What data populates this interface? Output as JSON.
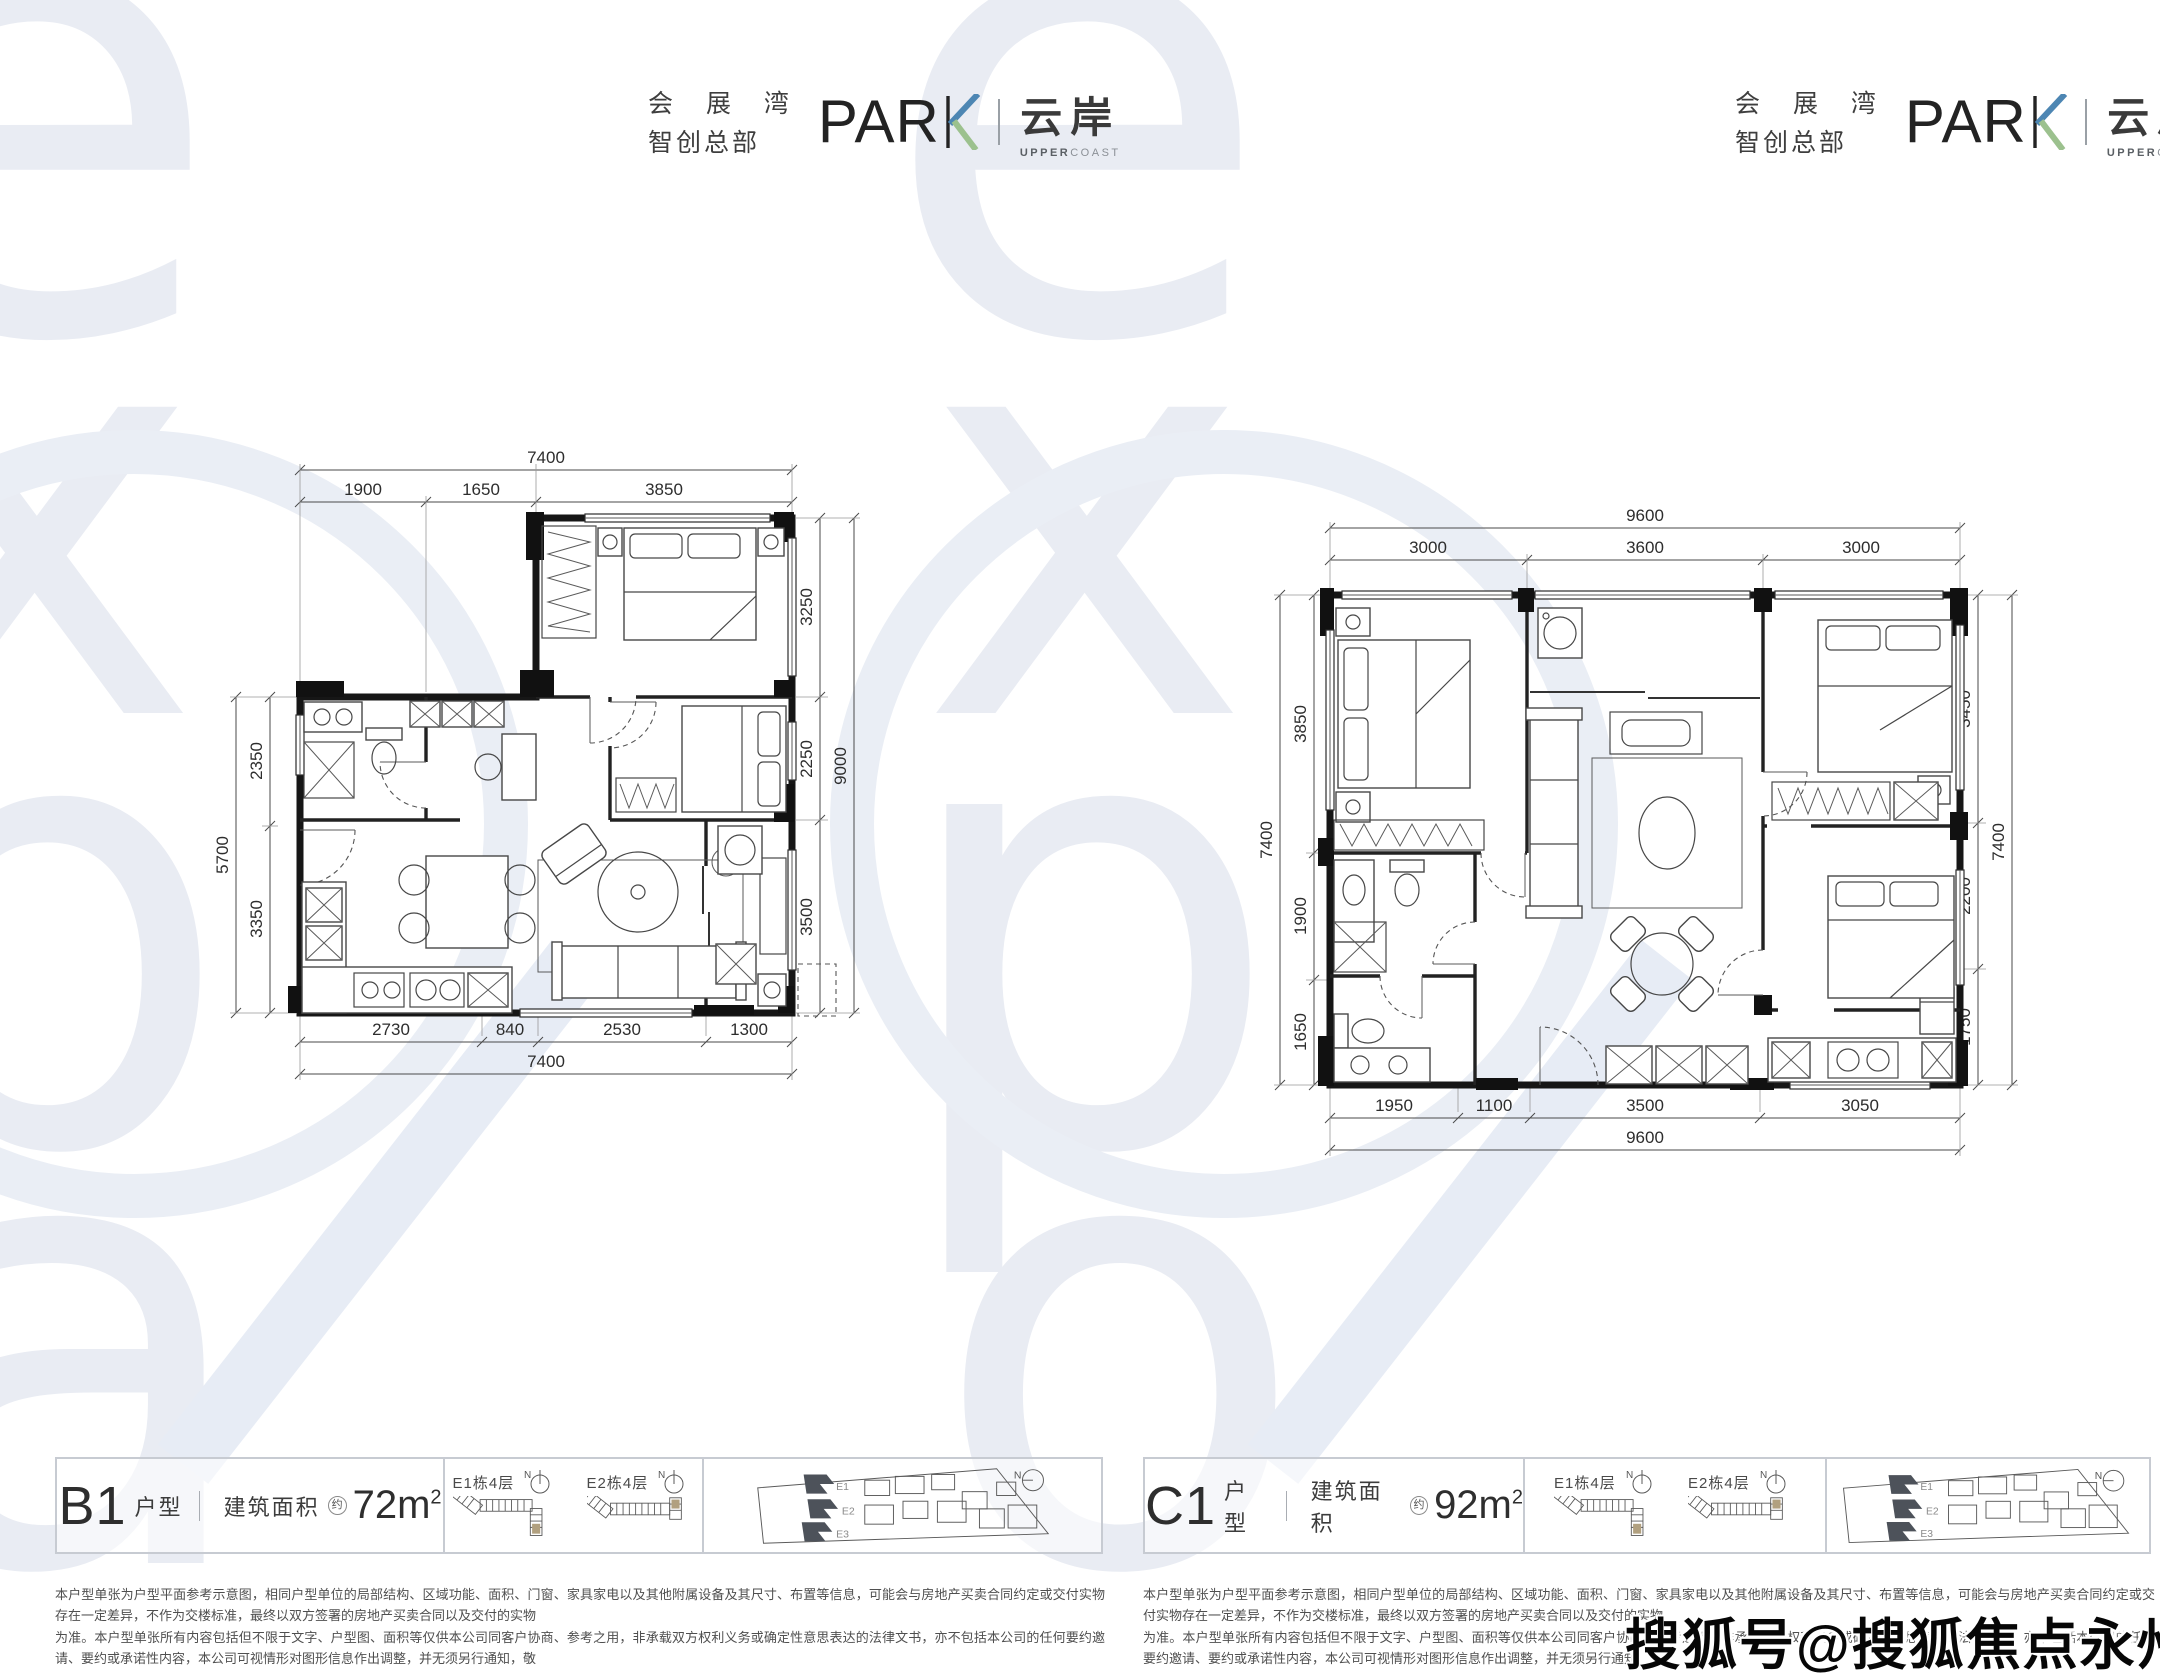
{
  "logo": {
    "cn_line1": "会 展 湾",
    "cn_line2": "智创总部",
    "park": "PAR",
    "brand": "云岸",
    "brand_sub_strong": "UPPER",
    "brand_sub_light": "COAST"
  },
  "plans": {
    "b1": {
      "code": "B1",
      "type_label": "户型",
      "area_label": "建筑面积",
      "approx": "约",
      "area": "72m",
      "area_exp": "2",
      "dims": {
        "top_total": "7400",
        "top": [
          "1900",
          "1650",
          "3850"
        ],
        "left_total": "5700",
        "left": [
          "2350",
          "3350"
        ],
        "right_total": "9000",
        "right": [
          "3250",
          "2250",
          "3500"
        ],
        "bottom_total": "7400",
        "bottom": [
          "2730",
          "840",
          "2530",
          "1300"
        ]
      }
    },
    "c1": {
      "code": "C1",
      "type_label": "户型",
      "area_label": "建筑面积",
      "approx": "约",
      "area": "92m",
      "area_exp": "2",
      "dims": {
        "top_total": "9600",
        "top": [
          "3000",
          "3600",
          "3000"
        ],
        "left_total": "7400",
        "left": [
          "3850",
          "1900",
          "1650"
        ],
        "right_total": "7400",
        "right": [
          "3450",
          "2200",
          "1750"
        ],
        "bottom_total": "9600",
        "bottom": [
          "1950",
          "1100",
          "3500",
          "3050"
        ]
      }
    }
  },
  "legend": {
    "e1": "E1栋4层",
    "e2": "E2栋4层",
    "north": "N",
    "site_e1": "E1",
    "site_e2": "E2",
    "site_e3": "E3"
  },
  "disclaimer": {
    "line1": "本户型单张为户型平面参考示意图，相同户型单位的局部结构、区域功能、面积、门窗、家具家电以及其他附属设备及其尺寸、布置等信息，可能会与房地产买卖合同约定或交付实物存在一定差异，不作为交楼标准，最终以双方签署的房地产买卖合同以及交付的实物",
    "line2": "为准。本户型单张所有内容包括但不限于文字、户型图、面积等仅供本公司同客户协商、参考之用，非承载双方权利义务或确定性意思表达的法律文书，亦不包括本公司的任何要约邀请、要约或承诺性内容，本公司可视情形对图形信息作出调整，并无须另行通知，敬",
    "line3": "请留意本公司最新宣传说明。该户型单张上的户型平面落位为标准层平面图，不同楼层的户型分布可能会存在差异；部分户型结构、户型落位为镜像关系，敬请留意。印刷日期：2021年6月。"
  },
  "watermark": {
    "sohu": "搜狐号@搜狐焦点永州站",
    "letters": {
      "e": "e",
      "x": "x",
      "p": "p",
      "o": "o",
      "a": "a"
    },
    "colors": {
      "accent_blue": "#4d86b3",
      "accent_green": "#9cc18e",
      "tan": "#b1a07f"
    }
  }
}
